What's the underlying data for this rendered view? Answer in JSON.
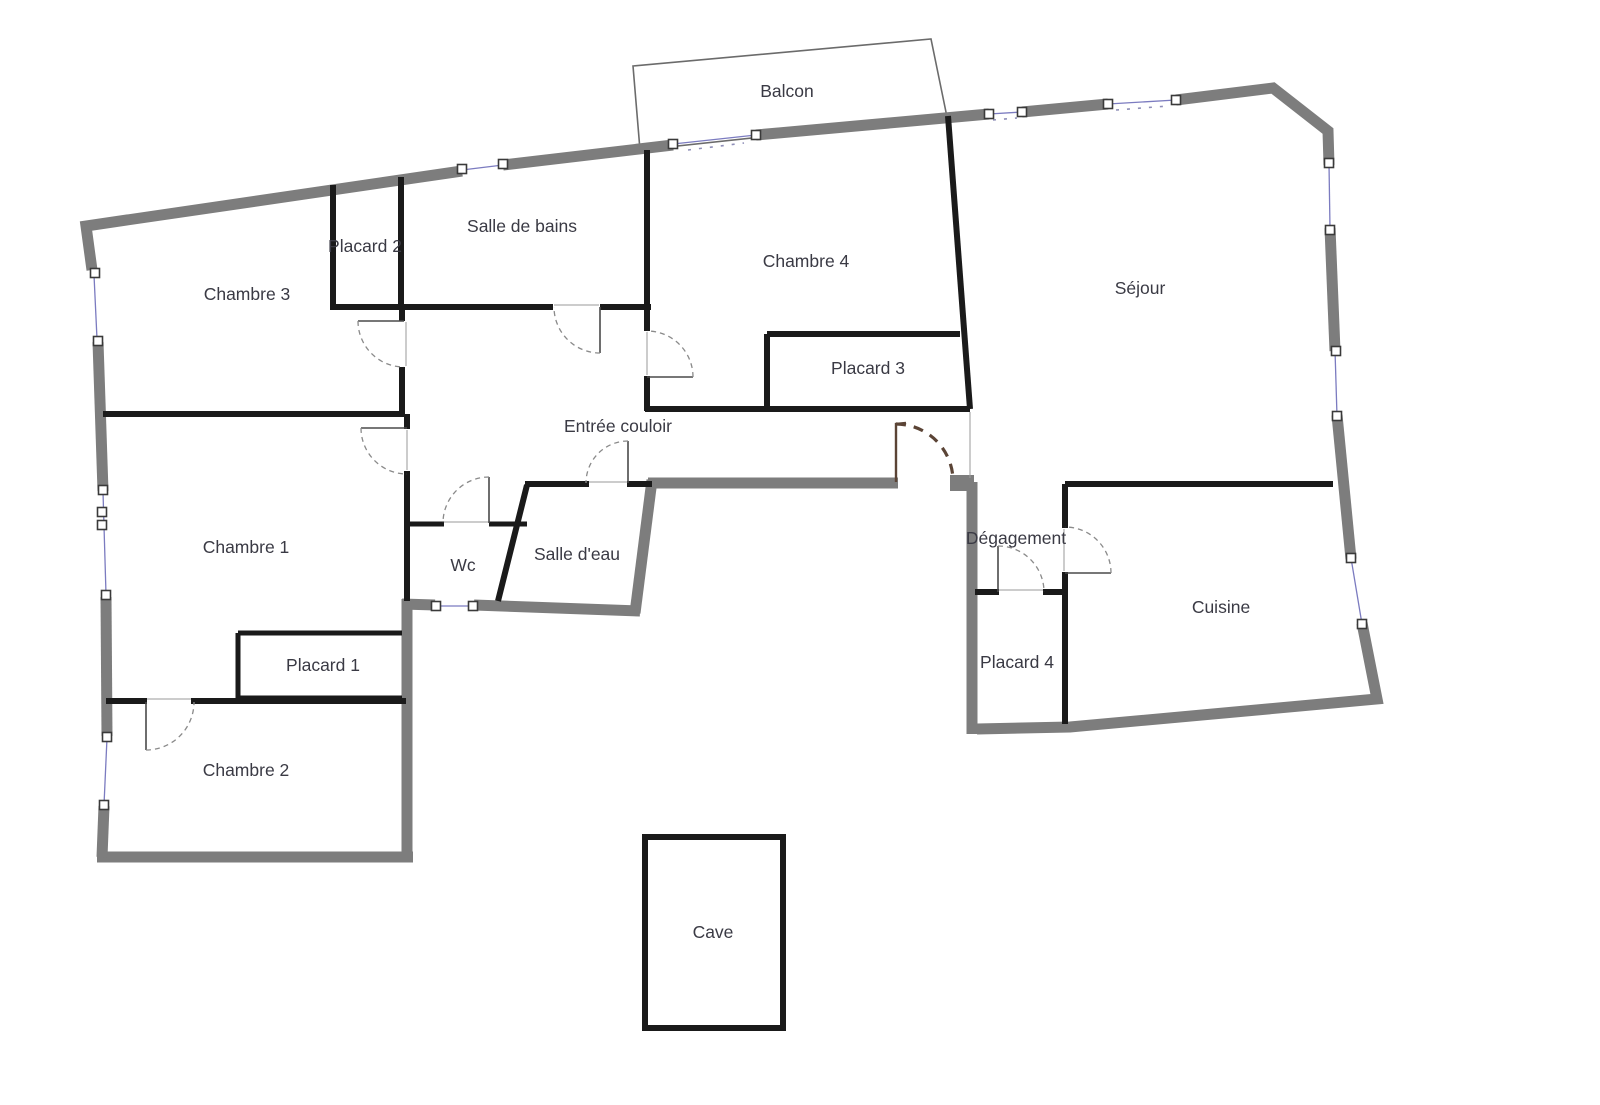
{
  "document": {
    "type": "apartment-floor-plan"
  },
  "colors": {
    "background": "#ffffff",
    "exterior_wall": "#7d7d7d",
    "interior_wall": "#1a1a1a",
    "window_line": "#7b7bc0",
    "door_arc": "#8a8a8a",
    "entry_door": "#5b4436",
    "label_text": "#3a3a44"
  },
  "rooms": {
    "balcon": {
      "label": "Balcon"
    },
    "chambre3": {
      "label": "Chambre 3"
    },
    "placard2": {
      "label": "Placard 2"
    },
    "salle_de_bains": {
      "label": "Salle de bains"
    },
    "chambre4": {
      "label": "Chambre 4"
    },
    "sejour": {
      "label": "Séjour"
    },
    "placard3": {
      "label": "Placard 3"
    },
    "entree": {
      "label": "Entrée couloir"
    },
    "chambre1": {
      "label": "Chambre 1"
    },
    "wc": {
      "label": "Wc"
    },
    "salle_deau": {
      "label": "Salle d'eau"
    },
    "degagement": {
      "label": "Dégagement"
    },
    "cuisine": {
      "label": "Cuisine"
    },
    "placard1": {
      "label": "Placard 1"
    },
    "placard4": {
      "label": "Placard 4"
    },
    "chambre2": {
      "label": "Chambre 2"
    },
    "cave": {
      "label": "Cave"
    }
  }
}
